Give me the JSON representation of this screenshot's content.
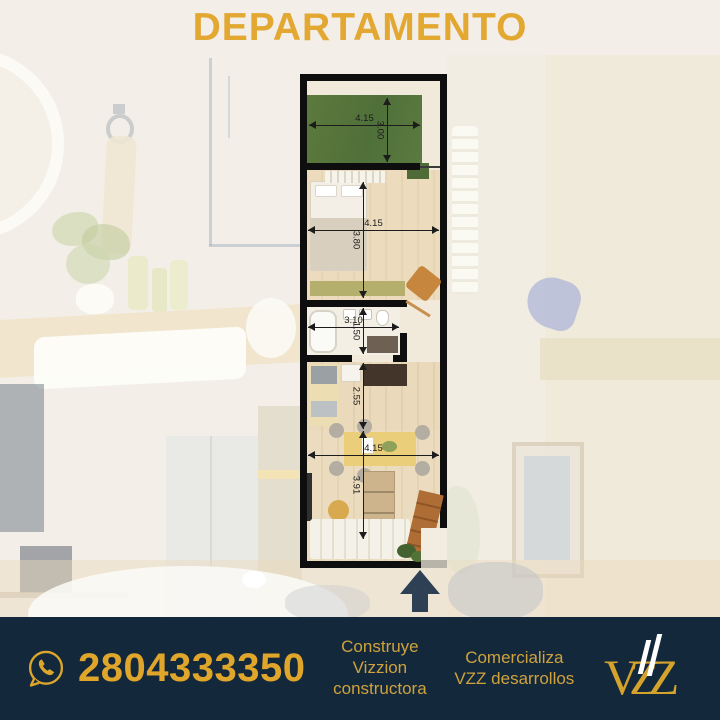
{
  "title": "DEPARTAMENTO",
  "floor_plan": {
    "rooms": {
      "terrace": {
        "width": "4.15",
        "height": "3.00"
      },
      "bedroom": {
        "width": "4.15",
        "height": "3.80"
      },
      "bathroom": {
        "width": "3.10",
        "height": "1.50"
      },
      "kitchen": {
        "height": "2.55"
      },
      "living": {
        "width": "4.15",
        "height": "3.91"
      }
    }
  },
  "footer": {
    "phone": "2804333350",
    "builder_lines": [
      "Construye",
      "Vizzion",
      "constructora"
    ],
    "seller_lines": [
      "Comercializa",
      "VZZ desarrollos"
    ],
    "logo_text": "VZZ"
  },
  "colors": {
    "accent_gold": "#e2a832",
    "footer_navy": "#13293b",
    "arrow_navy": "#2e4154",
    "terrace_green": "#5c7a3e"
  }
}
